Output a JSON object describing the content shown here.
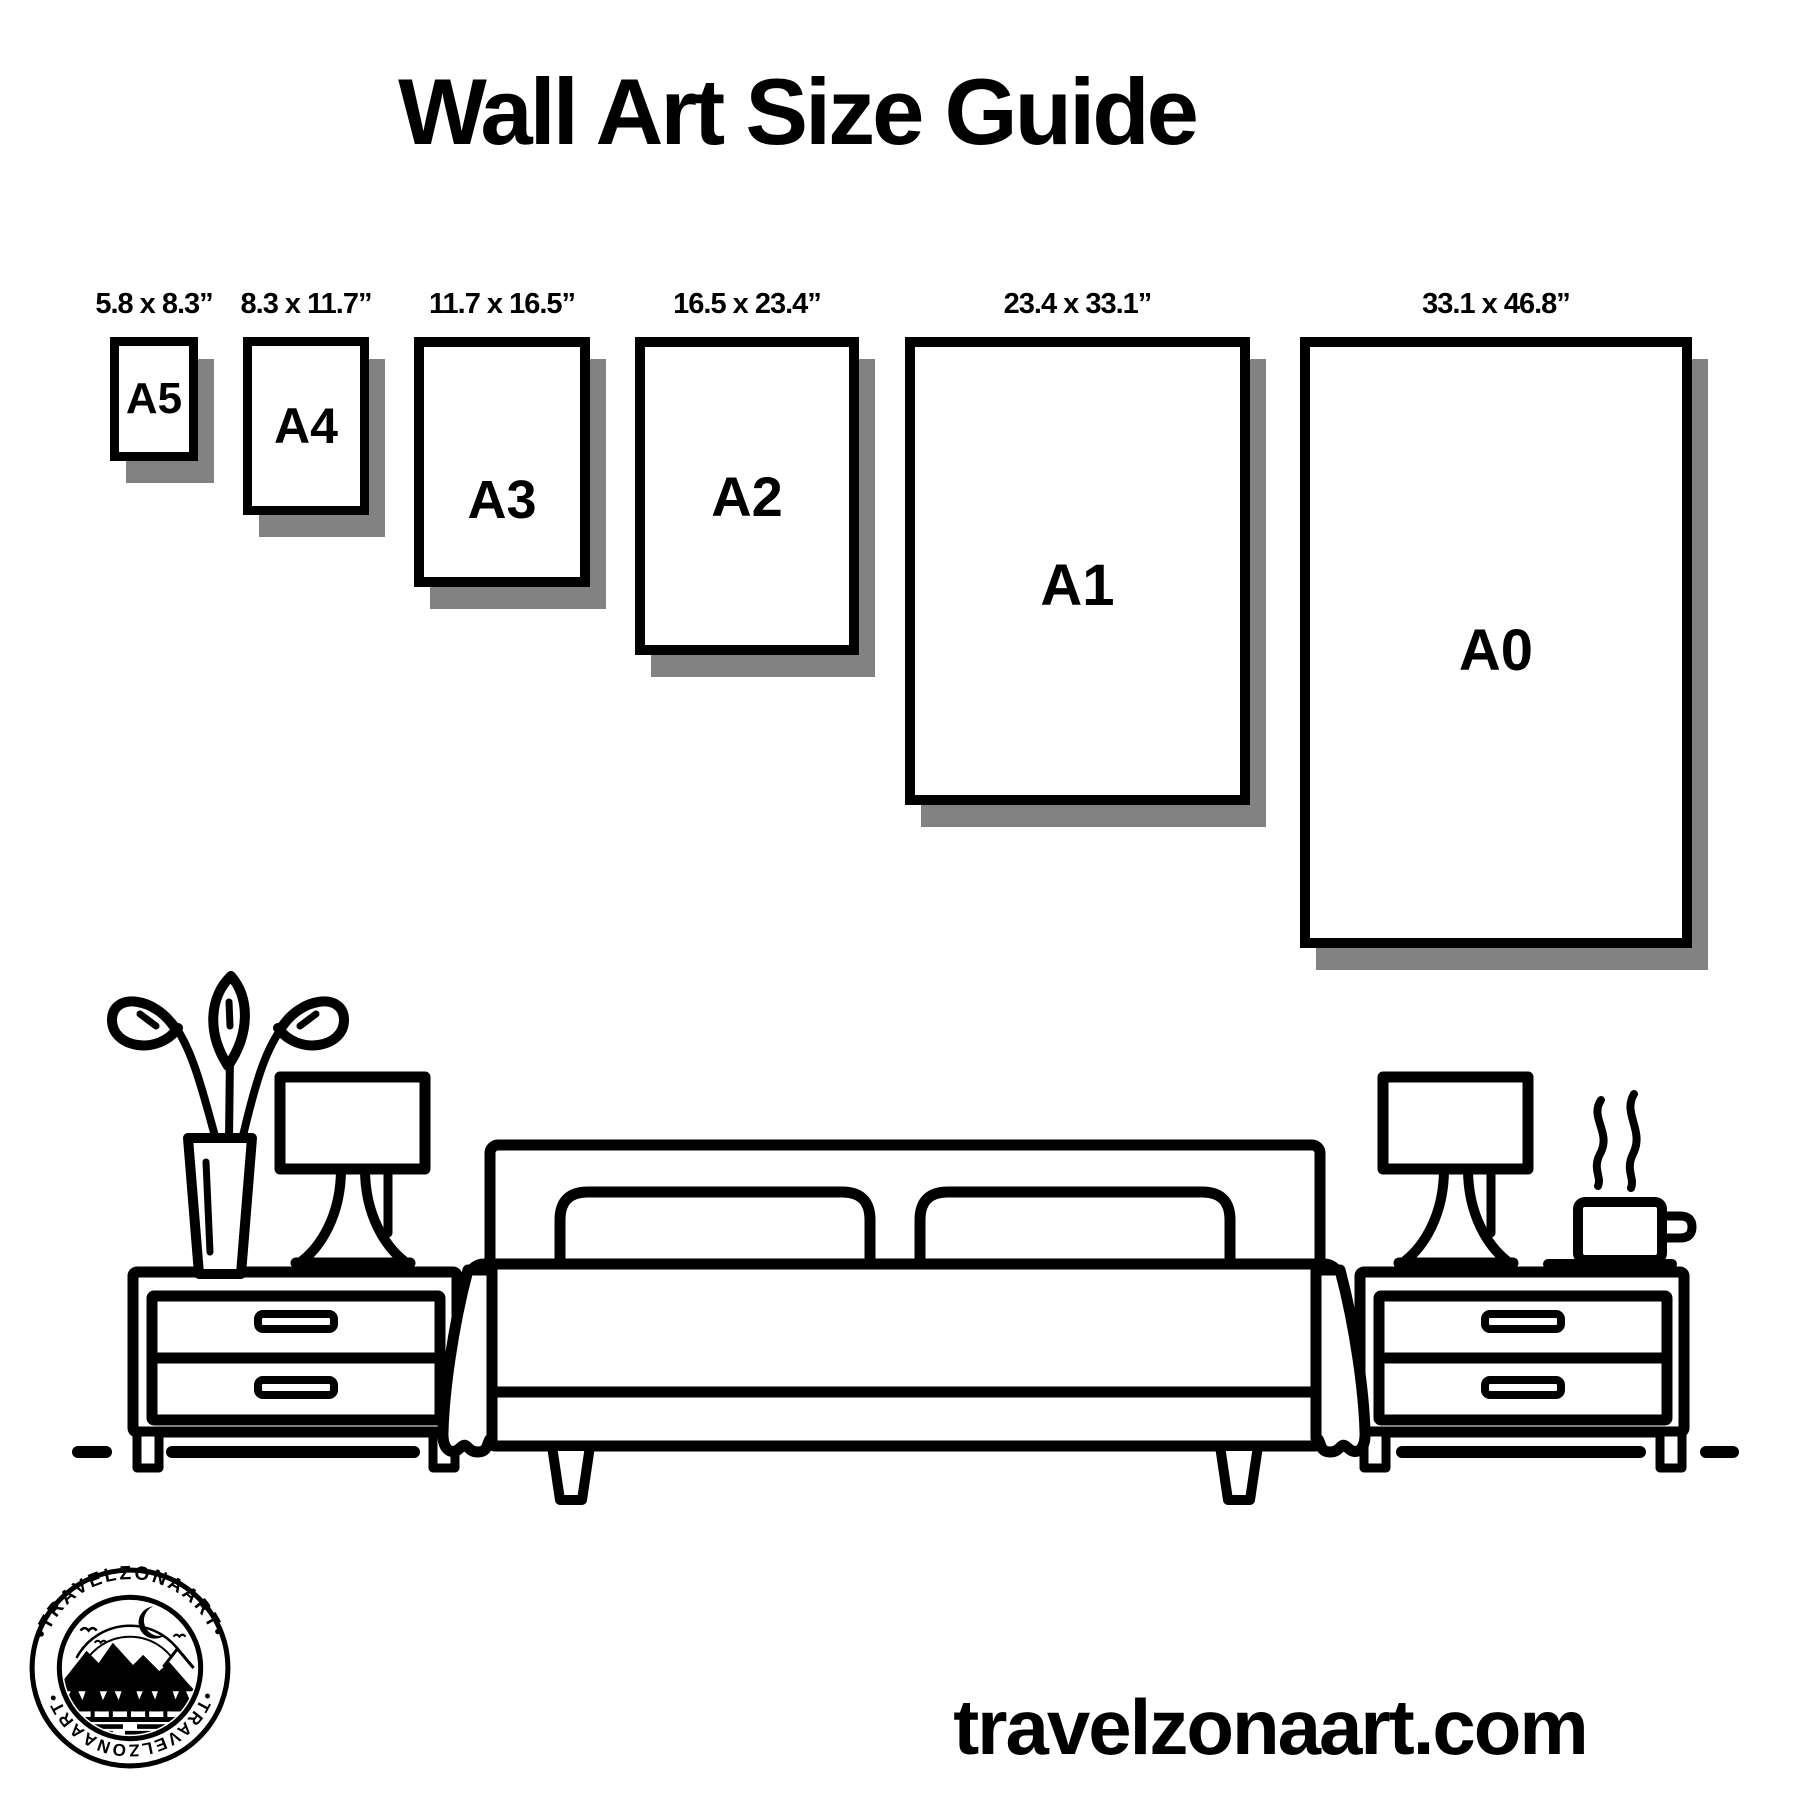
{
  "title": "Wall Art Size Guide",
  "sizes": [
    {
      "code": "A5",
      "dimensions": "5.8 x 8.3”"
    },
    {
      "code": "A4",
      "dimensions": "8.3 x 11.7”"
    },
    {
      "code": "A3",
      "dimensions": "11.7 x 16.5”"
    },
    {
      "code": "A2",
      "dimensions": "16.5 x 23.4”"
    },
    {
      "code": "A1",
      "dimensions": "23.4 x 33.1”"
    },
    {
      "code": "A0",
      "dimensions": "33.1 x 46.8”"
    }
  ],
  "logo": {
    "brand_top": "•TRAVELZONAART•",
    "brand_bottom": "•TRAVELZONAART•"
  },
  "footer": {
    "website": "travelzonaart.com"
  },
  "illustration": {
    "icons": [
      "plant-icon",
      "table-lamp-icon",
      "nightstand-icon",
      "bed-icon",
      "pillow-icon",
      "coffee-cup-icon",
      "steam-icon",
      "floor-line"
    ]
  },
  "colors": {
    "ink": "#000000",
    "shadow": "#828282",
    "background": "#ffffff"
  }
}
